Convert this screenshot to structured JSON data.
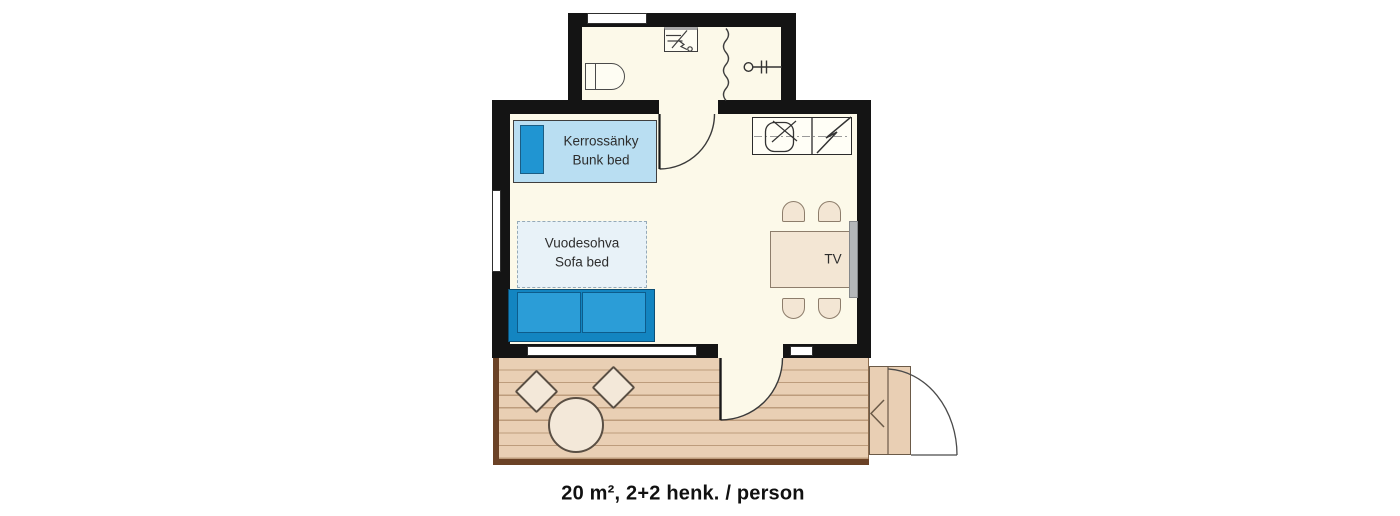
{
  "plan": {
    "caption": "20 m², 2+2 henk. / person",
    "area": "20 m²",
    "capacity": "2+2 henk. / person",
    "bunk_bed": {
      "label_fi": "Kerrossänky",
      "label_en": "Bunk bed"
    },
    "sofa_bed": {
      "label_fi": "Vuodesohva",
      "label_en": "Sofa bed"
    },
    "tv_label": "TV"
  },
  "colors": {
    "wall": "#141414",
    "floor": "#fcf9e9",
    "bunk_bed_fill": "#b9def2",
    "bed_accent_blue": "#2095d2",
    "sofa_fill": "#1385c1",
    "sofa_cushion": "#2b9dd7",
    "sofa_bed_area_fill": "#e8f2f8",
    "deck_fill": "#e9cfb4",
    "deck_plank_line": "#bd9c7c",
    "deck_border": "#6b4226",
    "furniture_beige": "#f3e6d4",
    "tv_gray": "#b4b7b9"
  }
}
